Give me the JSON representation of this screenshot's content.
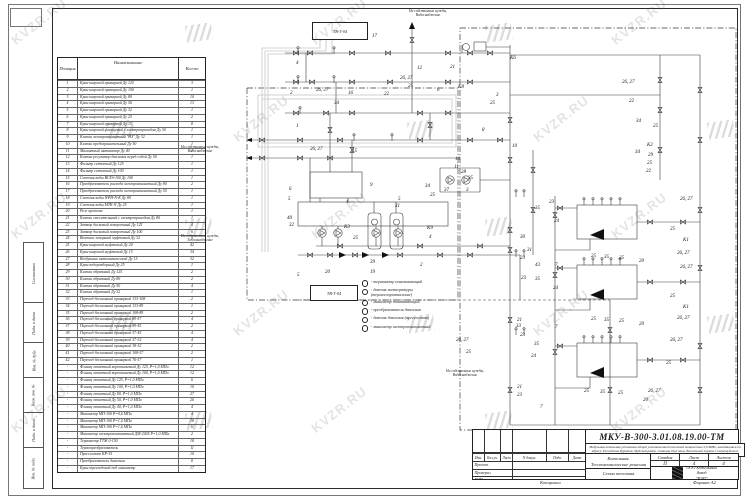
{
  "meta": {
    "watermark_text": "KVZR.RU"
  },
  "sidebar": {
    "boxes": [
      "Согласовано",
      "Подп. и дата",
      "Инв. № дубл.",
      "Взам. инв. №",
      "Подп. и дата",
      "Инв. № подл."
    ]
  },
  "table": {
    "headers": {
      "pos": "Позиция",
      "name": "Наименование",
      "qty": "Кол-во"
    },
    "rows": [
      [
        "1",
        "Кран шаровой приварной Ду 125",
        "3"
      ],
      [
        "2",
        "Кран шаровой приварной Ду 100",
        "1"
      ],
      [
        "3",
        "Кран шаровой приварной Ду 80",
        "10"
      ],
      [
        "4",
        "Кран шаровой приварной Ду 50",
        "13"
      ],
      [
        "5",
        "Кран шаровой приварной Ду 32",
        "1"
      ],
      [
        "6",
        "Кран шаровой приварной Ду 25",
        "2"
      ],
      [
        "7",
        "Кран шаровой приварной Ду 15",
        "8"
      ],
      [
        "8",
        "Кран шаровой фланцевый с электроприводом Ду 50",
        "1"
      ],
      [
        "9",
        "Клапан электромагнитный \"НЗ\" Ду 32",
        "1"
      ],
      [
        "10",
        "Клапан предохранительный Ду 50",
        "1"
      ],
      [
        "11",
        "Магнитный активатор Ду 40",
        "1"
      ],
      [
        "12",
        "Клапан-регулятор давления перед собой Ду 50",
        "1"
      ],
      [
        "13",
        "Фильтр сетчатый Ду 125",
        "1"
      ],
      [
        "14",
        "Фильтр сетчатый Ду 100",
        "1"
      ],
      [
        "15",
        "Счетчик воды ВСХд-100 Ду 100",
        "1"
      ],
      [
        "16",
        "Преобразователь расхода электромагнитный Ду 80",
        "2"
      ],
      [
        "17",
        "Преобразователь расхода электромагнитный Ду 50",
        "1"
      ],
      [
        "18",
        "Счетчик воды WPH-N-K Ду 80",
        "1"
      ],
      [
        "19",
        "Счетчик воды МТК-N Ду 25",
        "1"
      ],
      [
        "20",
        "Реле протока",
        "1"
      ],
      [
        "21",
        "Клапан смесительный с электроприводом Ду 80",
        "1"
      ],
      [
        "22",
        "Затвор дисковый поворотный Ду 125",
        "4"
      ],
      [
        "23",
        "Затвор дисковый поворотный Ду 100",
        "6"
      ],
      [
        "24",
        "Вентиль запорный муфтовый Ду 32",
        "4"
      ],
      [
        "25",
        "Кран шаровой муфтовый Ду 20",
        "42"
      ],
      [
        "26",
        "Кран шаровой муфтовый Ду 15",
        "34"
      ],
      [
        "27",
        "Воздушник автоматический Ду 15",
        "32"
      ],
      [
        "28",
        "Кран водоразборный Ду 25",
        "1"
      ],
      [
        "29",
        "Клапан обратный Ду 125",
        "2"
      ],
      [
        "30",
        "Клапан обратный Ду 80",
        "2"
      ],
      [
        "31",
        "Клапан обратный Ду 50",
        "4"
      ],
      [
        "32",
        "Клапан обратный Ду 32",
        "1"
      ],
      [
        "33",
        "Переход бесшовный приварной 133-108",
        "2"
      ],
      [
        "34",
        "Переход бесшовный приварной 133-89",
        "1"
      ],
      [
        "35",
        "Переход бесшовный приварной 108-89",
        "2"
      ],
      [
        "36",
        "Переход бесшовный приварной 89-57",
        "4"
      ],
      [
        "37",
        "Переход бесшовный приварной 89-45",
        "2"
      ],
      [
        "38",
        "Переход бесшовный приварной 57-45",
        "4"
      ],
      [
        "39",
        "Переход бесшовный приварной 57-32",
        "4"
      ],
      [
        "40",
        "Переход бесшовный приварной 38-32",
        "2"
      ],
      [
        "41",
        "Переход бесшовный приварной 108-57",
        "2"
      ],
      [
        "42",
        "Переход бесшовный приварной 76-57",
        "1"
      ],
      [
        "-",
        "Фланец ответный воротниковый Ду 125, Р=1,0 МПа",
        "12"
      ],
      [
        "-",
        "Фланец ответный воротниковый Ду 100, Р=1,0 МПа",
        "12"
      ],
      [
        "-",
        "Фланец ответный Ду 125, Р=1,0 МПа",
        "6"
      ],
      [
        "-",
        "Фланец ответный Ду 100, Р=1,0 МПа",
        "10"
      ],
      [
        "-",
        "Фланец ответный Ду 80, Р=1,0 МПа",
        "27"
      ],
      [
        "-",
        "Фланец ответный Ду 50, Р=1,0 МПа",
        "26"
      ],
      [
        "-",
        "Фланец ответный Ду 40, Р=1,0 МПа",
        "4"
      ],
      [
        "-",
        "Манометр МП-100 Р=0,6 МПа",
        "4"
      ],
      [
        "-",
        "Манометр МП-100 Р=1,0 МПа",
        "18"
      ],
      [
        "-",
        "Манометр МП-100 Р=1,6 МПа",
        "11"
      ],
      [
        "-",
        "Манометр электроконтактный ДМ-2005 Р=1,0 МПа",
        "2"
      ],
      [
        "-",
        "Термометр ТТЖ 0-150",
        "18"
      ],
      [
        "-",
        "Термопреобразователь",
        "11"
      ],
      [
        "-",
        "Прессостат КР-35",
        "10"
      ],
      [
        "-",
        "Преобразователь давления",
        "8"
      ],
      [
        "-",
        "Кран трехходовой под манометр",
        "17"
      ]
    ]
  },
  "diagram": {
    "boxes": [
      {
        "label": "ТВ-Т-04"
      },
      {
        "label": "ТВ-Т-04"
      }
    ],
    "notes": [
      {
        "text": "На собственные нужды,\nВодоснабжение"
      },
      {
        "text": "На собственные нужды,\nВодоснабжение"
      },
      {
        "text": "На собственные нужды,\nТеплоснабжение"
      },
      {
        "text": "На собственные нужды,\nВодоснабжение"
      }
    ],
    "legend": [
      "- термометр показывающий",
      "- датчик температуры\n(термосопротивление)",
      "- манометр показывающий",
      "- преобразователь давления",
      "- датчик давления (прессостат)",
      "- манометр электроконтактный"
    ],
    "labels": [
      [
        "4",
        296,
        64
      ],
      [
        "17",
        372,
        37
      ],
      [
        "12",
        417,
        69
      ],
      [
        "26, 27",
        400,
        79
      ],
      [
        "21",
        450,
        68
      ],
      [
        "К6",
        510,
        59
      ],
      [
        "16",
        348,
        94
      ],
      [
        "34",
        334,
        104
      ],
      [
        "26, 27",
        316,
        91
      ],
      [
        "2",
        290,
        94
      ],
      [
        "22",
        384,
        95
      ],
      [
        "25",
        408,
        87
      ],
      [
        "6",
        437,
        91
      ],
      [
        "К8",
        458,
        88
      ],
      [
        "3",
        496,
        96
      ],
      [
        "25",
        490,
        104
      ],
      [
        "1",
        296,
        127
      ],
      [
        "26, 27",
        310,
        150
      ],
      [
        "15",
        352,
        152
      ],
      [
        "8",
        482,
        131
      ],
      [
        "10",
        512,
        147
      ],
      [
        "10",
        455,
        160
      ],
      [
        "11",
        454,
        168
      ],
      [
        "28",
        461,
        173
      ],
      [
        "25",
        468,
        179
      ],
      [
        "9",
        370,
        186
      ],
      [
        "5",
        398,
        200
      ],
      [
        "31",
        395,
        207
      ],
      [
        "4",
        346,
        203
      ],
      [
        "6",
        289,
        190
      ],
      [
        "5",
        288,
        200
      ],
      [
        "40",
        287,
        219
      ],
      [
        "32",
        289,
        226
      ],
      [
        "К3",
        344,
        228
      ],
      [
        "25",
        353,
        239
      ],
      [
        "К9",
        427,
        229
      ],
      [
        "4",
        429,
        238
      ],
      [
        "34",
        425,
        187
      ],
      [
        "37",
        444,
        191
      ],
      [
        "3",
        466,
        191
      ],
      [
        "25",
        430,
        196
      ],
      [
        "2",
        420,
        266
      ],
      [
        "39",
        370,
        263
      ],
      [
        "19",
        370,
        273
      ],
      [
        "20",
        325,
        273
      ],
      [
        "5",
        297,
        276
      ],
      [
        "26, 27",
        622,
        83
      ],
      [
        "22",
        629,
        102
      ],
      [
        "34",
        636,
        122
      ],
      [
        "25",
        653,
        127
      ],
      [
        "К2",
        647,
        146
      ],
      [
        "34",
        635,
        153
      ],
      [
        "29",
        648,
        156
      ],
      [
        "25",
        647,
        164
      ],
      [
        "22",
        646,
        172
      ],
      [
        "23",
        549,
        203
      ],
      [
        "35",
        535,
        209
      ],
      [
        "24",
        554,
        222
      ],
      [
        "30",
        520,
        238
      ],
      [
        "31",
        527,
        251
      ],
      [
        "23",
        520,
        259
      ],
      [
        "43",
        535,
        266
      ],
      [
        "7",
        555,
        266
      ],
      [
        "25",
        591,
        257
      ],
      [
        "35",
        604,
        258
      ],
      [
        "25",
        619,
        259
      ],
      [
        "20",
        639,
        262
      ],
      [
        "26, 27",
        680,
        200
      ],
      [
        "25",
        670,
        230
      ],
      [
        "К1",
        683,
        241
      ],
      [
        "26, 27",
        677,
        254
      ],
      [
        "23",
        521,
        279
      ],
      [
        "35",
        535,
        280
      ],
      [
        "24",
        553,
        289
      ],
      [
        "21",
        517,
        321
      ],
      [
        "33",
        516,
        327
      ],
      [
        "7",
        555,
        328
      ],
      [
        "23",
        520,
        336
      ],
      [
        "35",
        534,
        345
      ],
      [
        "25",
        591,
        320
      ],
      [
        "35",
        604,
        321
      ],
      [
        "25",
        619,
        322
      ],
      [
        "20",
        639,
        325
      ],
      [
        "26, 27",
        680,
        268
      ],
      [
        "25",
        670,
        297
      ],
      [
        "К1",
        683,
        308
      ],
      [
        "26, 27",
        677,
        319
      ],
      [
        "26, 27",
        456,
        341
      ],
      [
        "25",
        466,
        353
      ],
      [
        "24",
        531,
        357
      ],
      [
        "21",
        517,
        388
      ],
      [
        "23",
        517,
        396
      ],
      [
        "7",
        540,
        408
      ],
      [
        "25",
        584,
        392
      ],
      [
        "35",
        600,
        393
      ],
      [
        "25",
        618,
        394
      ],
      [
        "20",
        643,
        401
      ],
      [
        "26, 27",
        670,
        341
      ],
      [
        "25",
        666,
        364
      ],
      [
        "26, 27",
        648,
        392
      ],
      [
        "7",
        500,
        434
      ]
    ]
  },
  "title_block": {
    "doc_number": "МКУ-В-300-3.01.08.19.00-ТМ",
    "description": "Модульная котельная установка общей установленной тепловой мощностью 3,0 МВт, находящаяся по адресу: Республика Бурятия, Муйский район, станция Окусикан, Восточный портал Северомуйского тоннеля.",
    "object": "Котельная.\nТепломеханические решения",
    "sheet_title": "Схема тепловая",
    "stage_label": "Стадия",
    "sheet_label": "Лист",
    "sheets_label": "Листов",
    "stage": "П",
    "sheet": "4",
    "sheets": "4",
    "company": "ООО Котельный\nЗавод\n\"РЭП\"",
    "columns": [
      "Изм.",
      "Кол.уч.",
      "Лист",
      "N докум.",
      "Подп.",
      "Дата"
    ],
    "roles": [
      "Проект.",
      "Проверил",
      "ГИП"
    ],
    "footer_left": "Копировал",
    "footer_right": "Формат А2"
  }
}
